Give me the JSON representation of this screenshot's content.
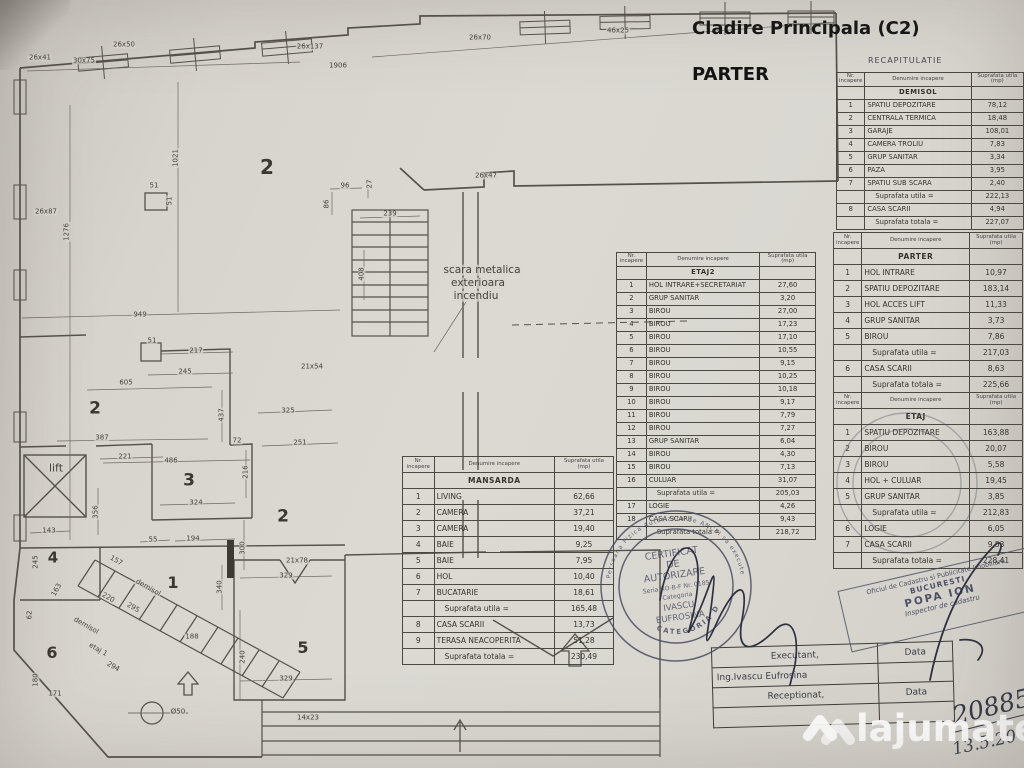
{
  "header": {
    "building_title": "Cladire Principala (C2)",
    "floor_title": "PARTER",
    "recap_title": "RECAPITULATIE"
  },
  "tables": {
    "headers": [
      "Nr. incapere",
      "Denumire incapere",
      "Suprafata utila (mp)"
    ],
    "demisol": {
      "title": "DEMISOL",
      "rows": [
        [
          "1",
          "SPATIU DEPOZITARE",
          "78,12"
        ],
        [
          "2",
          "CENTRALA TERMICA",
          "18,48"
        ],
        [
          "3",
          "GARAJE",
          "108,01"
        ],
        [
          "4",
          "CAMERA TROLIU",
          "7,83"
        ],
        [
          "5",
          "GRUP SANITAR",
          "3,34"
        ],
        [
          "6",
          "PAZA",
          "3,95"
        ],
        [
          "7",
          "SPATIU SUB SCARA",
          "2,40"
        ],
        [
          "",
          "Suprafata utila =",
          "222,13"
        ],
        [
          "8",
          "CASA SCARII",
          "4,94"
        ],
        [
          "",
          "Suprafata totala =",
          "227,07"
        ]
      ]
    },
    "parter": {
      "title": "PARTER",
      "rows": [
        [
          "1",
          "HOL INTRARE",
          "10,97"
        ],
        [
          "2",
          "SPATIU DEPOZITARE",
          "183,14"
        ],
        [
          "3",
          "HOL ACCES LIFT",
          "11,33"
        ],
        [
          "4",
          "GRUP SANITAR",
          "3,73"
        ],
        [
          "5",
          "BIROU",
          "7,86"
        ],
        [
          "",
          "Suprafata utila =",
          "217,03"
        ],
        [
          "6",
          "CASA SCARII",
          "8,63"
        ],
        [
          "",
          "Suprafata totala =",
          "225,66"
        ]
      ]
    },
    "etaj": {
      "title": "ETAJ",
      "rows": [
        [
          "1",
          "SPATIU DEPOZITARE",
          "163,88"
        ],
        [
          "2",
          "BIROU",
          "20,07"
        ],
        [
          "3",
          "BIROU",
          "5,58"
        ],
        [
          "4",
          "HOL + CULUAR",
          "19,45"
        ],
        [
          "5",
          "GRUP SANITAR",
          "3,85"
        ],
        [
          "",
          "Suprafata utila =",
          "212,83"
        ],
        [
          "6",
          "LOGIE",
          "6,05"
        ],
        [
          "7",
          "CASA SCARII",
          "9,53"
        ],
        [
          "",
          "Suprafata totala =",
          "228,41"
        ]
      ]
    },
    "etaj2": {
      "title": "ETAJ2",
      "rows": [
        [
          "1",
          "HOL INTRARE+SECRETARIAT",
          "27,60"
        ],
        [
          "2",
          "GRUP SANITAR",
          "3,20"
        ],
        [
          "3",
          "BIROU",
          "27,00"
        ],
        [
          "4",
          "BIROU",
          "17,23"
        ],
        [
          "5",
          "BIROU",
          "17,10"
        ],
        [
          "6",
          "BIROU",
          "10,55"
        ],
        [
          "7",
          "BIROU",
          "9,15"
        ],
        [
          "8",
          "BIROU",
          "10,25"
        ],
        [
          "9",
          "BIROU",
          "10,18"
        ],
        [
          "10",
          "BIROU",
          "9,17"
        ],
        [
          "11",
          "BIROU",
          "7,79"
        ],
        [
          "12",
          "BIROU",
          "7,27"
        ],
        [
          "13",
          "GRUP SANITAR",
          "6,04"
        ],
        [
          "14",
          "BIROU",
          "4,30"
        ],
        [
          "15",
          "BIROU",
          "7,13"
        ],
        [
          "16",
          "CULUAR",
          "31,07"
        ],
        [
          "",
          "Suprafata utila =",
          "205,03"
        ],
        [
          "17",
          "LOGIE",
          "4,26"
        ],
        [
          "18",
          "CASA SCARII",
          "9,43"
        ],
        [
          "",
          "Suprafata totala =",
          "218,72"
        ]
      ]
    },
    "mansarda": {
      "title": "MANSARDA",
      "rows": [
        [
          "1",
          "LIVING",
          "62,66"
        ],
        [
          "2",
          "CAMERA",
          "37,21"
        ],
        [
          "3",
          "CAMERA",
          "19,40"
        ],
        [
          "4",
          "BAIE",
          "9,25"
        ],
        [
          "5",
          "BAIE",
          "7,95"
        ],
        [
          "6",
          "HOL",
          "10,40"
        ],
        [
          "7",
          "BUCATARIE",
          "18,61"
        ],
        [
          "",
          "Suprafata utila =",
          "165,48"
        ],
        [
          "8",
          "CASA SCARII",
          "13,73"
        ],
        [
          "9",
          "TERASA NEACOPERITA",
          "51,28"
        ],
        [
          "",
          "Suprafata totala =",
          "230,49"
        ]
      ]
    }
  },
  "plan": {
    "labels": [
      {
        "t": "26x41",
        "x": 40,
        "y": 58
      },
      {
        "t": "30x75",
        "x": 84,
        "y": 61
      },
      {
        "t": "26x50",
        "x": 124,
        "y": 45
      },
      {
        "t": "26x137",
        "x": 310,
        "y": 47
      },
      {
        "t": "1906",
        "x": 338,
        "y": 66
      },
      {
        "t": "26x70",
        "x": 480,
        "y": 38
      },
      {
        "t": "46x25",
        "x": 618,
        "y": 31
      },
      {
        "t": "26x47",
        "x": 486,
        "y": 176
      },
      {
        "t": "96",
        "x": 345,
        "y": 186
      },
      {
        "t": "27",
        "x": 370,
        "y": 184,
        "r": -90
      },
      {
        "t": "86",
        "x": 327,
        "y": 204,
        "r": -90
      },
      {
        "t": "239",
        "x": 390,
        "y": 214
      },
      {
        "t": "408",
        "x": 362,
        "y": 274,
        "r": -90
      },
      {
        "t": "1021",
        "x": 176,
        "y": 158,
        "r": -90
      },
      {
        "t": "1276",
        "x": 67,
        "y": 232,
        "r": -90
      },
      {
        "t": "26x87",
        "x": 46,
        "y": 212
      },
      {
        "t": "51",
        "x": 154,
        "y": 186
      },
      {
        "t": "51",
        "x": 170,
        "y": 201,
        "r": -90
      },
      {
        "t": "2",
        "x": 267,
        "y": 167,
        "s": 20,
        "n": "room-2-hall"
      },
      {
        "t": "scara metalica",
        "x": 482,
        "y": 270,
        "s": 10.5
      },
      {
        "t": "exterioara",
        "x": 478,
        "y": 283,
        "s": 10.5
      },
      {
        "t": "incendiu",
        "x": 476,
        "y": 296,
        "s": 10.5
      },
      {
        "t": "949",
        "x": 140,
        "y": 315
      },
      {
        "t": "51",
        "x": 152,
        "y": 341
      },
      {
        "t": "217",
        "x": 196,
        "y": 351
      },
      {
        "t": "245",
        "x": 185,
        "y": 372
      },
      {
        "t": "605",
        "x": 126,
        "y": 383
      },
      {
        "t": "437",
        "x": 222,
        "y": 415,
        "r": -90
      },
      {
        "t": "2",
        "x": 95,
        "y": 409,
        "s": 17,
        "n": "room-2-mid"
      },
      {
        "t": "387",
        "x": 102,
        "y": 438
      },
      {
        "t": "72",
        "x": 237,
        "y": 441
      },
      {
        "t": "221",
        "x": 125,
        "y": 457
      },
      {
        "t": "486",
        "x": 171,
        "y": 461
      },
      {
        "t": "216",
        "x": 246,
        "y": 472,
        "r": -90
      },
      {
        "t": "lift",
        "x": 56,
        "y": 468,
        "s": 11,
        "n": "lift-label"
      },
      {
        "t": "3",
        "x": 189,
        "y": 481,
        "s": 17,
        "n": "room-3"
      },
      {
        "t": "21x54",
        "x": 312,
        "y": 367
      },
      {
        "t": "325",
        "x": 288,
        "y": 411
      },
      {
        "t": "251",
        "x": 300,
        "y": 443
      },
      {
        "t": "2",
        "x": 283,
        "y": 517,
        "s": 17,
        "n": "room-2-low"
      },
      {
        "t": "324",
        "x": 196,
        "y": 503
      },
      {
        "t": "356",
        "x": 96,
        "y": 512,
        "r": -90
      },
      {
        "t": "143",
        "x": 49,
        "y": 531
      },
      {
        "t": "55",
        "x": 153,
        "y": 540
      },
      {
        "t": "194",
        "x": 193,
        "y": 539
      },
      {
        "t": "300",
        "x": 243,
        "y": 548,
        "r": -90
      },
      {
        "t": "4",
        "x": 53,
        "y": 558,
        "s": 15,
        "n": "room-4"
      },
      {
        "t": "245",
        "x": 36,
        "y": 562,
        "r": -90
      },
      {
        "t": "163",
        "x": 57,
        "y": 590,
        "r": -62
      },
      {
        "t": "62",
        "x": 30,
        "y": 615,
        "r": -90
      },
      {
        "t": "157",
        "x": 116,
        "y": 561,
        "r": 30
      },
      {
        "t": "220",
        "x": 108,
        "y": 598,
        "r": 30
      },
      {
        "t": "1",
        "x": 173,
        "y": 583,
        "s": 16,
        "n": "room-1"
      },
      {
        "t": "demisol",
        "x": 148,
        "y": 588,
        "r": 30
      },
      {
        "t": "295",
        "x": 133,
        "y": 608,
        "r": 30
      },
      {
        "t": "demisol",
        "x": 86,
        "y": 626,
        "r": 30
      },
      {
        "t": "etaj 1",
        "x": 98,
        "y": 650,
        "r": 30
      },
      {
        "t": "294",
        "x": 113,
        "y": 667,
        "r": 30
      },
      {
        "t": "6",
        "x": 52,
        "y": 653,
        "s": 16,
        "n": "room-6"
      },
      {
        "t": "180",
        "x": 36,
        "y": 680,
        "r": -90
      },
      {
        "t": "171",
        "x": 55,
        "y": 694
      },
      {
        "t": "188",
        "x": 192,
        "y": 637
      },
      {
        "t": "340",
        "x": 220,
        "y": 587,
        "r": -90
      },
      {
        "t": "21x78",
        "x": 297,
        "y": 561
      },
      {
        "t": "329",
        "x": 286,
        "y": 576
      },
      {
        "t": "5",
        "x": 303,
        "y": 648,
        "s": 16,
        "n": "room-5"
      },
      {
        "t": "240",
        "x": 243,
        "y": 657,
        "r": -90
      },
      {
        "t": "329",
        "x": 286,
        "y": 679
      },
      {
        "t": "14x23",
        "x": 308,
        "y": 718
      },
      {
        "t": "Ø50",
        "x": 178,
        "y": 712
      }
    ]
  },
  "stamps": {
    "round": {
      "line1": "CERTIFICAT",
      "line2": "DE",
      "line3": "AUTORIZARE",
      "line4": "Seria RO-B-F Nr. 0185",
      "line5": "Categoria",
      "line6": "IVASCU",
      "line7": "EUFROSINA",
      "arc_top": "Persoana Fizica Autorizata de ANCPI sa execute lucrari",
      "arc_bottom": "CATEGORIA D"
    },
    "office": {
      "line1": "Oficiul de Cadastru si Publicitate Imobiliara",
      "line2": "BUCURESTI",
      "line3": "POPA ION",
      "line4": "Inspector de cadastru"
    }
  },
  "sign_block": {
    "executant": "Executant,",
    "data1": "Data",
    "name": "Ing.Ivascu Eufrosina",
    "receptionat": "Receptionat,",
    "data2": "Data"
  },
  "handwriting": {
    "number": "20885",
    "date": "13.5.20"
  },
  "watermark": {
    "text": "lajumate",
    "tld": ".ro"
  }
}
